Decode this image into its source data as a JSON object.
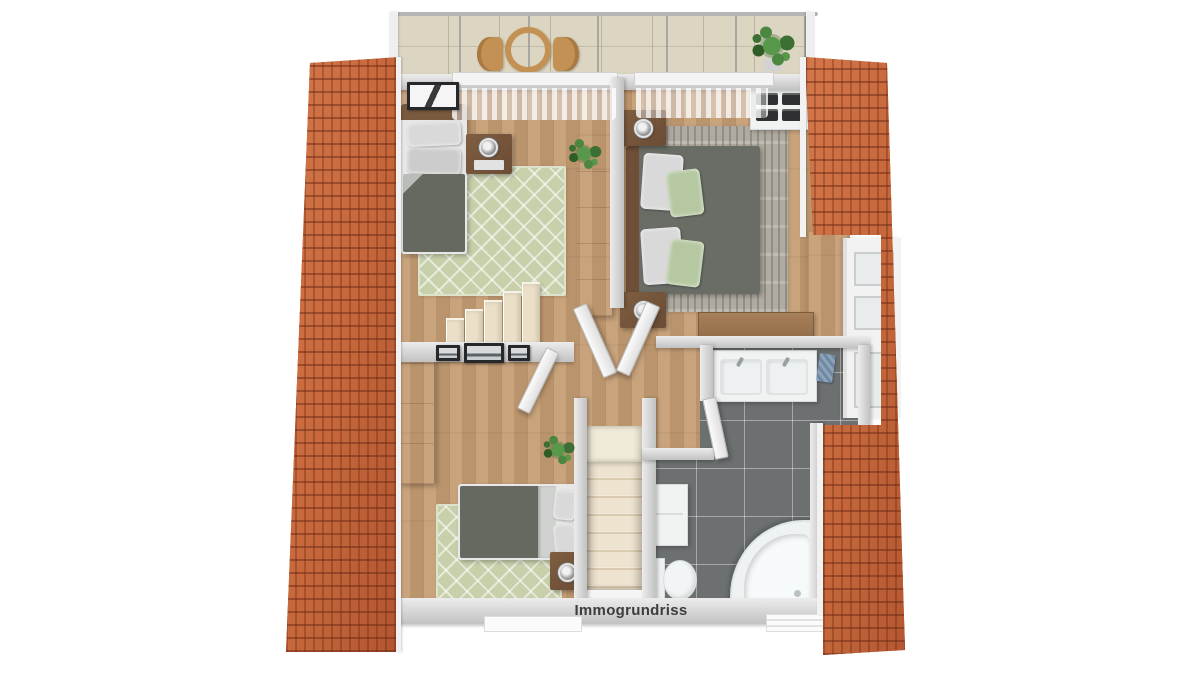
{
  "watermark": {
    "label": "Immogrundriss"
  },
  "palette": {
    "background": "#ffffff",
    "roof_tile": "#c4663a",
    "roof_tile_shadow": "#7d3a1f",
    "wall_gray": "#c7c7c7",
    "wood_floor": "#c49c72",
    "balcony_tile": "#dbd5c1",
    "bathroom_tile": "#6c7070",
    "tile_grout": "#aeb4b4",
    "rug_green": "#c8d0ab",
    "rug_gray_taupe": "#b0aba0",
    "bedding_gray": "#65695f",
    "pillow_white": "#d9d9d9",
    "pillow_green": "#b5c8a2",
    "furniture_wood_brown": "#7a573c",
    "stair_cream": "#e9ddc6",
    "fixture_white": "#f2f5f5",
    "plant_green": "#4c8741",
    "towel_blue": "#7e95ad"
  },
  "floorplan": {
    "type": "3d-top-down-floor-plan",
    "areas": [
      {
        "name": "balcony",
        "items": [
          "railing",
          "round-table",
          "chair",
          "chair",
          "potted-plant"
        ]
      },
      {
        "name": "bedroom-upper-left",
        "items": [
          "single-bed",
          "wall-art",
          "nightstand",
          "table-lamp",
          "area-rug",
          "wardrobe",
          "potted-plant",
          "curtains"
        ]
      },
      {
        "name": "bedroom-upper-right",
        "items": [
          "double-bed",
          "nightstand",
          "table-lamp",
          "nightstand",
          "table-lamp",
          "area-rug",
          "drawer-dresser",
          "desk",
          "curtains"
        ]
      },
      {
        "name": "hallway-landing",
        "items": [
          "upper-staircase",
          "lower-staircase",
          "gallery-pictures",
          "potted-plant",
          "interior-doors"
        ]
      },
      {
        "name": "bedroom-lower-left",
        "items": [
          "double-bed",
          "nightstand",
          "table-lamp",
          "area-rug",
          "wardrobe",
          "window"
        ]
      },
      {
        "name": "bathroom",
        "items": [
          "double-sink-vanity",
          "towel",
          "wall-cabinet",
          "toilet",
          "corner-bathtub",
          "window-radiator"
        ]
      }
    ],
    "roof": [
      "left-roof-slope",
      "right-roof-slope"
    ]
  }
}
